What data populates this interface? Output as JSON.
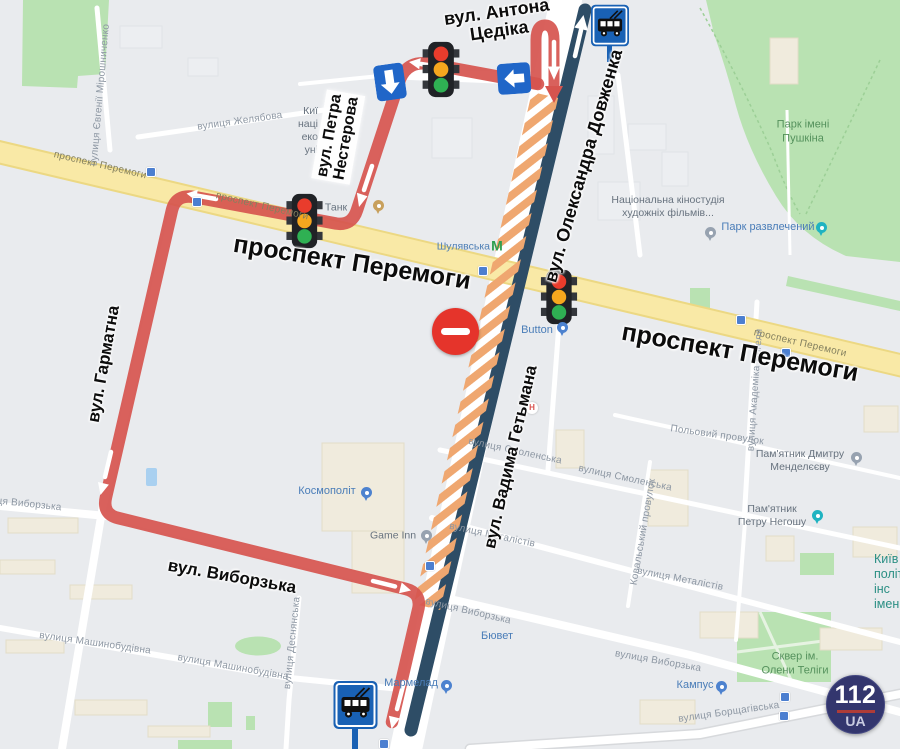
{
  "annotations": {
    "tsedika": {
      "line1": "вул. Антона",
      "line2": "Цедіка"
    },
    "nesterova": {
      "line1": "вул. Петра",
      "line2": "Нестерова"
    },
    "peremohy_left": "проспект Перемоги",
    "peremohy_right": "проспект Перемоги",
    "harmatna": "вул. Гарматна",
    "vyborzka": "вул. Виборзька",
    "dovzhenka": "вул. Олександра Довженка",
    "hetmana": "вул. Вадима Гетьмана"
  },
  "logo": {
    "top": "112",
    "bottom": "UA"
  },
  "icons": {
    "traffic_light": "traffic-light-icon",
    "one_way_left": "left-arrow-sign",
    "one_way_down": "down-arrow-sign",
    "trolleybus_stop": "trolleybus-stop-sign",
    "no_entry": "no-entry-sign",
    "metro": "М",
    "hospital": "Н"
  },
  "colors": {
    "detour_route_red": "#d6544e",
    "main_route_navy": "#2e4d66",
    "closure_hatch_orange": "#efa770",
    "highway_yellow": "#f8e7a3",
    "park_green": "#b9e2b2",
    "one_way_sign_blue": "#2066c8",
    "stop_sign_blue": "#1961b4",
    "no_entry_red": "#e5342b",
    "logo_navy": "#33366e",
    "logo_red": "#ae3c38"
  },
  "map_labels": [
    {
      "t": "вулиця Євгенії Мірошниченко",
      "c": "st",
      "x": 101,
      "y": 95,
      "r": -85
    },
    {
      "t": "вулиця Желябова",
      "c": "st",
      "x": 240,
      "y": 122,
      "r": -8
    },
    {
      "t": "проспект Перемоги",
      "c": "road",
      "x": 100,
      "y": 166,
      "r": 13
    },
    {
      "t": "проспект Перемоги",
      "c": "road",
      "x": 262,
      "y": 207,
      "r": 13
    },
    {
      "t": "проспект Перемоги",
      "c": "road",
      "x": 800,
      "y": 344,
      "r": 13
    },
    {
      "t": "Танк",
      "c": "poi-muted",
      "x": 336,
      "y": 208
    },
    {
      "t": "Шулявська",
      "c": "metro-label ar",
      "x": 490,
      "y": 247
    },
    {
      "t": "М",
      "c": "metro-m",
      "x": 497,
      "y": 246
    },
    {
      "l": [
        "Киї",
        "наці",
        "еко",
        "уні"
      ],
      "c": "poi-muted ar",
      "x": 318,
      "y": 131
    },
    {
      "l": [
        "Національна кіностудія",
        "художніх фільмів..."
      ],
      "c": "poi-muted",
      "x": 668,
      "y": 207
    },
    {
      "l": [
        "Парк імені",
        "Пушкіна"
      ],
      "c": "park-label",
      "x": 803,
      "y": 132
    },
    {
      "t": "Парк развлечений",
      "c": "poi-blue",
      "x": 768,
      "y": 228
    },
    {
      "t": "Button",
      "c": "poi-blue",
      "x": 537,
      "y": 331
    },
    {
      "l": [
        "Пам'ятник Дмитру",
        "Менделєєву"
      ],
      "c": "poi-muted",
      "x": 800,
      "y": 461
    },
    {
      "l": [
        "Пам'ятник",
        "Петру Негошу"
      ],
      "c": "poi-muted",
      "x": 772,
      "y": 516
    },
    {
      "t": "Польовий провулок",
      "c": "st",
      "x": 717,
      "y": 436,
      "r": 8
    },
    {
      "t": "вулиця Академіка Янгеля",
      "c": "st",
      "x": 756,
      "y": 390,
      "r": -86
    },
    {
      "t": "вулиця Смоленська",
      "c": "st",
      "x": 515,
      "y": 452,
      "r": 12
    },
    {
      "t": "вулиця Смоленська",
      "c": "st",
      "x": 625,
      "y": 479,
      "r": 12
    },
    {
      "t": "Ковальський провулок",
      "c": "st",
      "x": 644,
      "y": 532,
      "r": -80
    },
    {
      "t": "вулиця Металістів",
      "c": "st",
      "x": 492,
      "y": 536,
      "r": 12
    },
    {
      "t": "вулиця Металістів",
      "c": "st",
      "x": 680,
      "y": 580,
      "r": 11
    },
    {
      "t": "вулиця Виборзька",
      "c": "st",
      "x": 18,
      "y": 504,
      "r": 6
    },
    {
      "t": "вулиця Виборзька",
      "c": "st",
      "x": 468,
      "y": 612,
      "r": 13
    },
    {
      "t": "вулиця Виборзька",
      "c": "st",
      "x": 658,
      "y": 662,
      "r": 10
    },
    {
      "t": "Бювет",
      "c": "poi-blue",
      "x": 497,
      "y": 637
    },
    {
      "t": "Космополіт",
      "c": "poi-blue",
      "x": 327,
      "y": 492
    },
    {
      "t": "Game Inn",
      "c": "poi-muted",
      "x": 393,
      "y": 536
    },
    {
      "t": "Мармелад",
      "c": "poi-blue",
      "x": 411,
      "y": 684
    },
    {
      "t": "Кампус",
      "c": "poi-blue",
      "x": 695,
      "y": 686
    },
    {
      "l": [
        "Сквер ім.",
        "Олени Теліги"
      ],
      "c": "park-label",
      "x": 795,
      "y": 664
    },
    {
      "t": "вулиця Борщагівська",
      "c": "st",
      "x": 729,
      "y": 713,
      "r": -8
    },
    {
      "t": "вулиця Машинобудівна",
      "c": "st",
      "x": 95,
      "y": 644,
      "r": 8
    },
    {
      "t": "вулиця Машинобудівна",
      "c": "st",
      "x": 233,
      "y": 668,
      "r": 10
    },
    {
      "t": "вулиця Деснянська",
      "c": "st",
      "x": 293,
      "y": 643,
      "r": -84
    },
    {
      "l": [
        "Київ",
        "політе",
        "інс",
        "імен"
      ],
      "c": "kpi-label al",
      "x": 874,
      "y": 582
    },
    {
      "t": "Н",
      "c": "hospital",
      "x": 532,
      "y": 408
    }
  ],
  "pins": [
    {
      "type": "shop",
      "x": 367,
      "y": 503
    },
    {
      "type": "gray",
      "x": 427,
      "y": 546
    },
    {
      "type": "shop",
      "x": 447,
      "y": 696
    },
    {
      "type": "shop",
      "x": 722,
      "y": 697
    },
    {
      "type": "shop",
      "x": 563,
      "y": 338
    },
    {
      "type": "teal",
      "x": 822,
      "y": 238
    },
    {
      "type": "teal",
      "x": 818,
      "y": 526
    },
    {
      "type": "gray",
      "x": 711,
      "y": 243
    },
    {
      "type": "gray",
      "x": 857,
      "y": 468
    },
    {
      "type": "tan",
      "x": 379,
      "y": 216
    }
  ],
  "transit_icons": [
    {
      "x": 151,
      "y": 172
    },
    {
      "x": 197,
      "y": 202
    },
    {
      "x": 483,
      "y": 271
    },
    {
      "x": 741,
      "y": 320
    },
    {
      "x": 786,
      "y": 353
    },
    {
      "x": 430,
      "y": 566
    },
    {
      "x": 384,
      "y": 744
    },
    {
      "x": 785,
      "y": 697
    },
    {
      "x": 784,
      "y": 716
    }
  ]
}
